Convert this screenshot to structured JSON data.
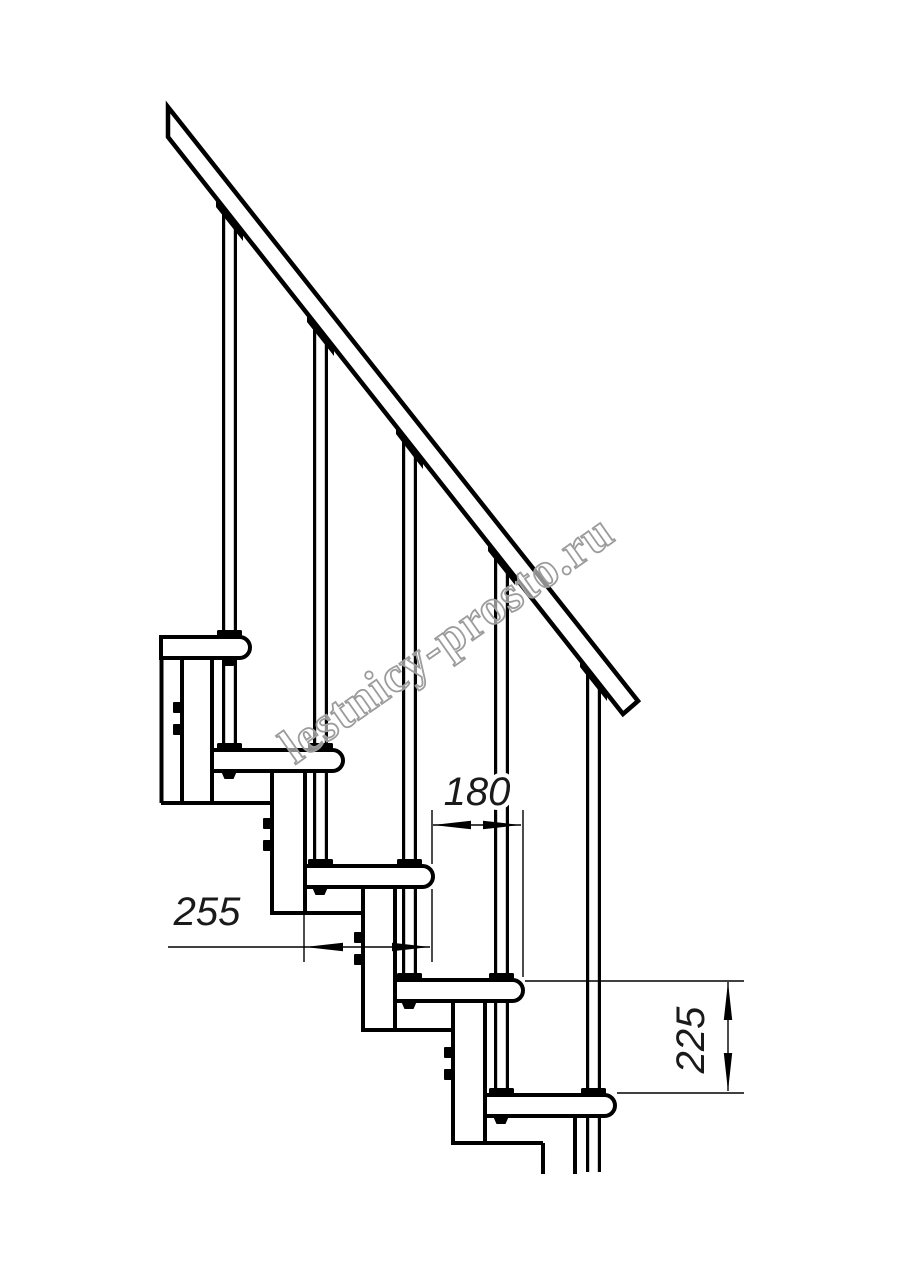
{
  "watermark": {
    "text": "lestnicy-prosto.ru"
  },
  "dimensions": {
    "going": {
      "value": "180",
      "orientation": "horizontal"
    },
    "tread_depth": {
      "value": "255",
      "orientation": "horizontal"
    },
    "rise": {
      "value": "225",
      "orientation": "vertical"
    }
  },
  "structure": {
    "type": "modular staircase side elevation",
    "treads_visible": "5",
    "balusters_visible": "5"
  },
  "colors": {
    "line": "#000000",
    "dimension_text": "#1a1a1a",
    "watermark_outline": "#9c9c9c",
    "background": "#ffffff"
  }
}
